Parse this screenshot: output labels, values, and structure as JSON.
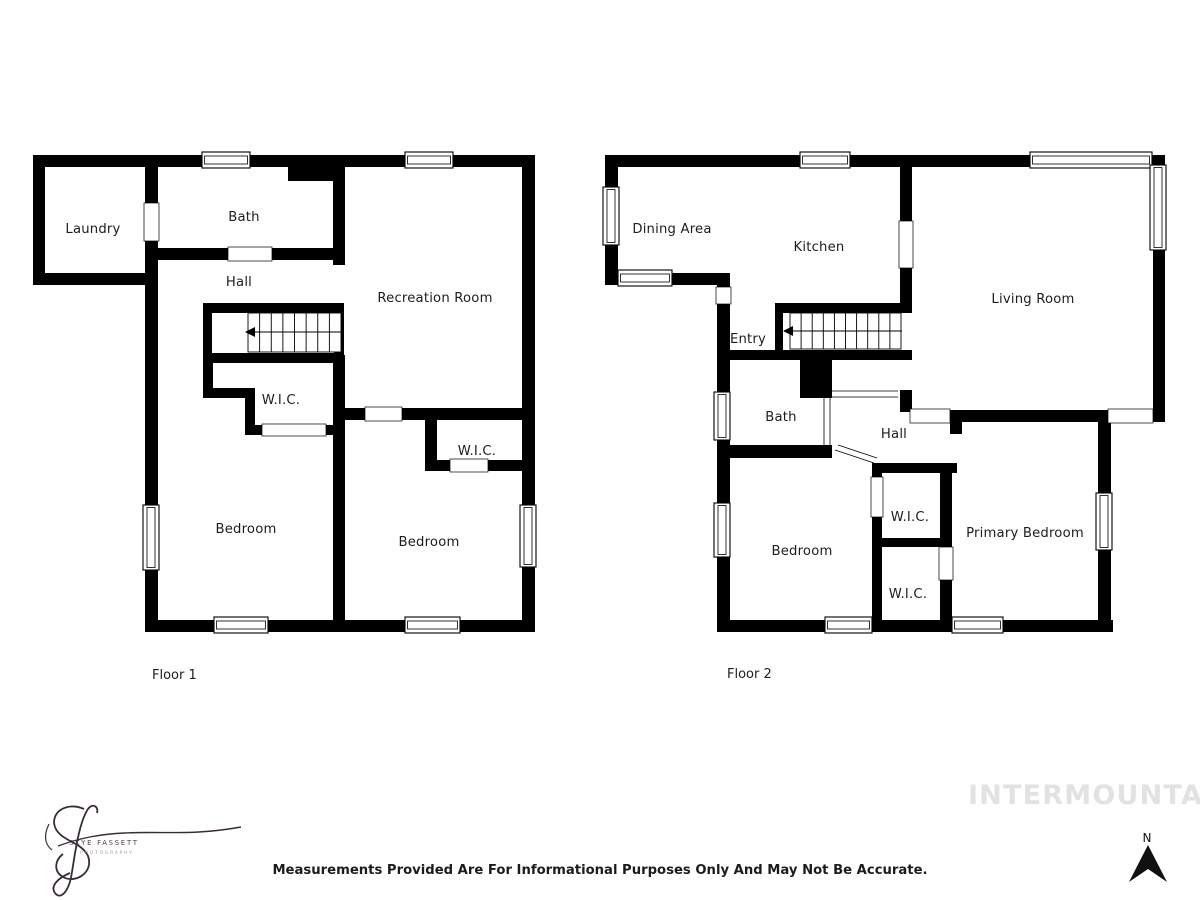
{
  "floor1": {
    "label": "Floor 1",
    "rooms": {
      "laundry": "Laundry",
      "bath": "Bath",
      "hall": "Hall",
      "recreation": "Recreation Room",
      "wic_a": "W.I.C.",
      "bedroom_left": "Bedroom",
      "wic_b": "W.I.C.",
      "bedroom_right": "Bedroom"
    }
  },
  "floor2": {
    "label": "Floor 2",
    "rooms": {
      "dining": "Dining Area",
      "kitchen": "Kitchen",
      "living": "Living Room",
      "entry": "Entry",
      "bath": "Bath",
      "hall": "Hall",
      "bedroom": "Bedroom",
      "wic_a": "W.I.C.",
      "wic_b": "W.I.C.",
      "primary": "Primary Bedroom"
    }
  },
  "footer": {
    "disclaimer": "Measurements Provided Are For Informational Purposes Only And May Not Be Accurate.",
    "watermark": "INTERMOUNTAIN"
  },
  "logo": {
    "name": "SKYE FASSETT",
    "tagline": "PHOTOGRAPHY"
  },
  "compass": {
    "north_label": "N"
  },
  "colors": {
    "wall": "#000000",
    "label_text": "#1d1d1d",
    "watermark": "#e2e2e2",
    "signature": "#3a2b3b"
  }
}
